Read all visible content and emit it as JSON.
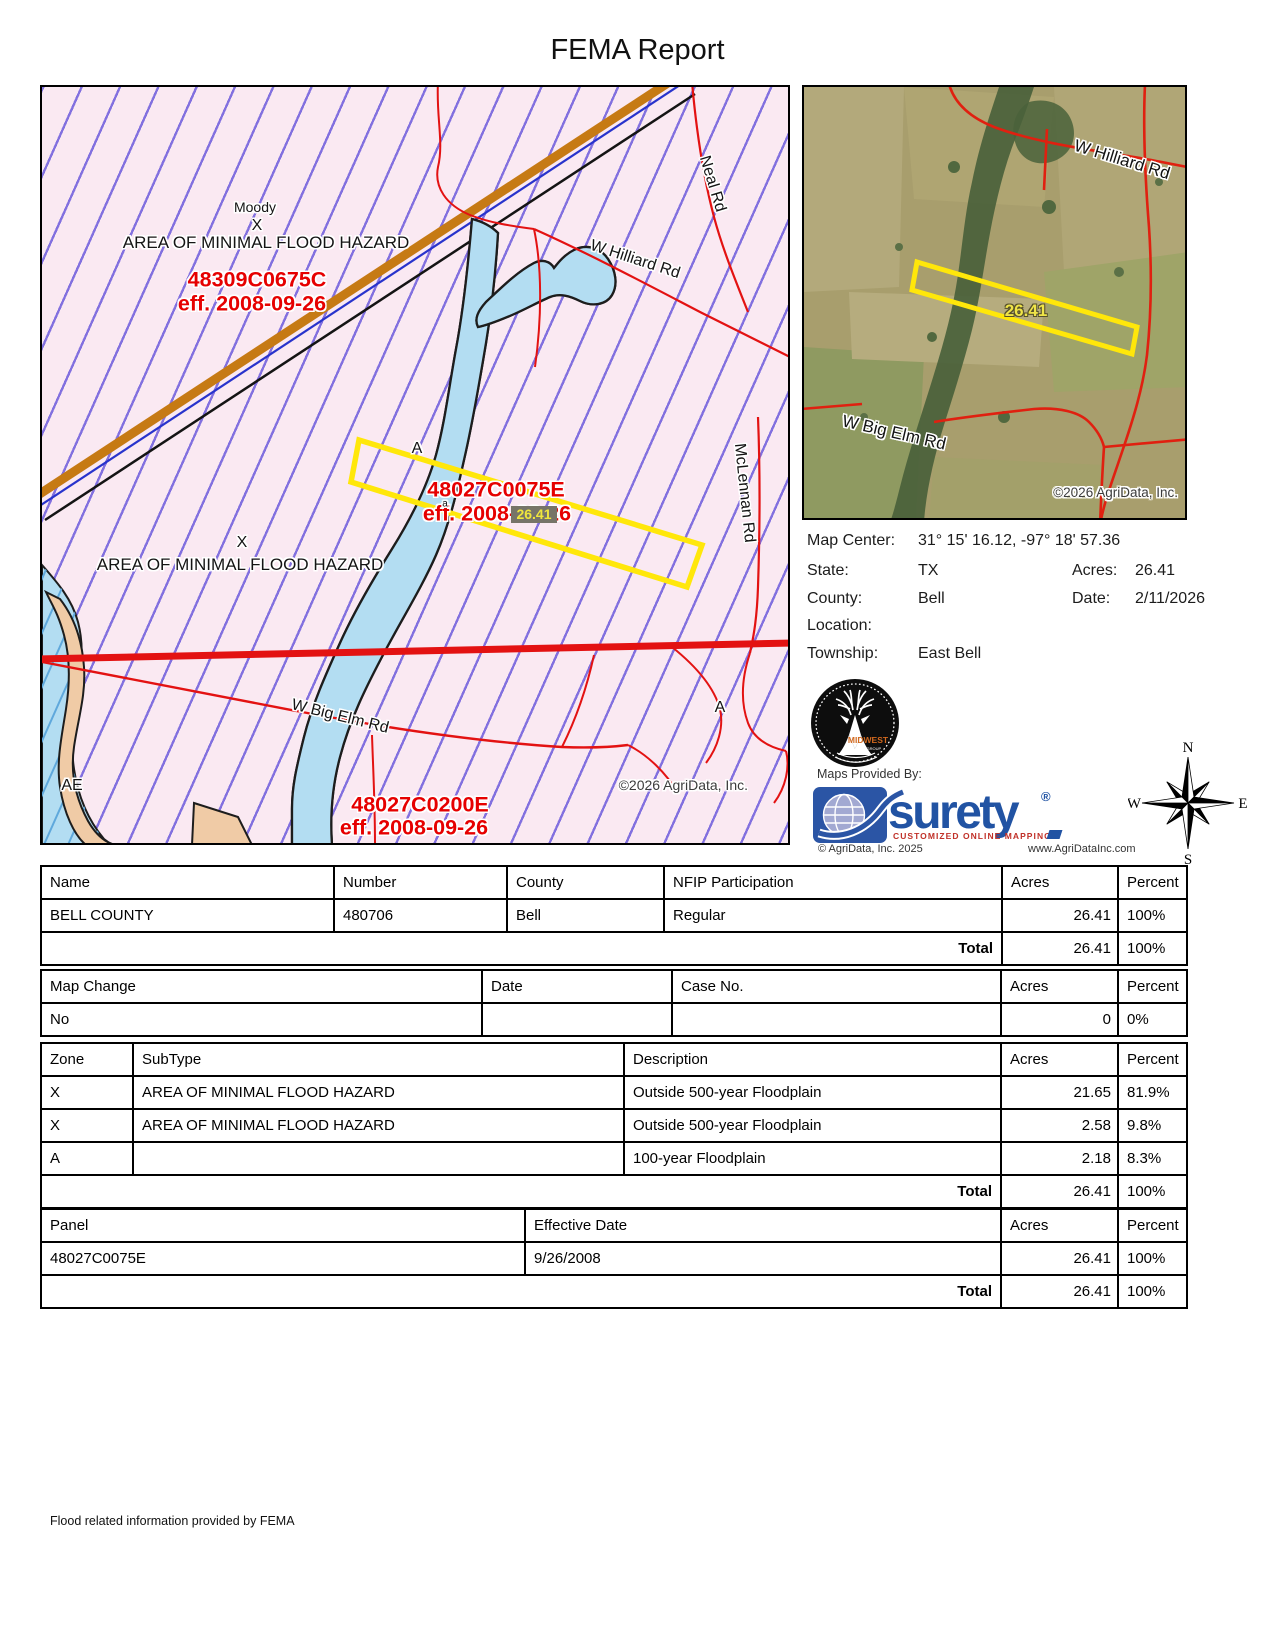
{
  "title": "FEMA Report",
  "flood_map": {
    "zone_labels": {
      "moody": "Moody",
      "x1": "X",
      "area1": "AREA OF MINIMAL FLOOD HAZARD",
      "x2": "X",
      "area2": "AREA OF MINIMAL FLOOD HAZARD",
      "a1": "A",
      "a2": "A",
      "ae": "AE"
    },
    "panels": {
      "p1": {
        "id": "48309C0675C",
        "eff": "eff. 2008-09-26"
      },
      "p2": {
        "id": "48027C0075E",
        "eff": "eff. 2008-09-26",
        "note": "a"
      },
      "p3": {
        "id": "48027C0200E",
        "eff": "eff. 2008-09-26"
      }
    },
    "acres_tag": "26.41",
    "roads": {
      "hilliard": "W Hilliard Rd",
      "neal": "Neal Rd",
      "mclennan": "McLennan Rd",
      "big_elm": "W Big Elm Rd"
    },
    "copyright": "©2026 AgriData, Inc."
  },
  "aerial_map": {
    "roads": {
      "hilliard": "W Hilliard Rd",
      "big_elm": "W Big Elm Rd"
    },
    "acres_label": "26.41",
    "copyright": "©2026 AgriData, Inc."
  },
  "info": {
    "map_center_label": "Map Center:",
    "map_center": "31° 15' 16.12,  -97° 18' 57.36",
    "state_label": "State:",
    "state": "TX",
    "acres_label": "Acres:",
    "acres": "26.41",
    "county_label": "County:",
    "county": "Bell",
    "date_label": "Date:",
    "date": "2/11/2026",
    "location_label": "Location:",
    "location": "",
    "township_label": "Township:",
    "township": "East Bell"
  },
  "branding": {
    "midwest_name": "MIDWEST",
    "midwest_sub": "LAND GROUP",
    "maps_provided_by": "Maps Provided By:",
    "surety": "surety",
    "registered": "®",
    "tagline": "CUSTOMIZED ONLINE MAPPING",
    "agridata_copyright": "© AgriData, Inc. 2025",
    "agridata_url": "www.AgriDataInc.com"
  },
  "compass": {
    "n": "N",
    "e": "E",
    "s": "S",
    "w": "W"
  },
  "tables": {
    "nfip": {
      "headers": [
        "Name",
        "Number",
        "County",
        "NFIP Participation",
        "Acres",
        "Percent"
      ],
      "rows": [
        [
          "BELL COUNTY",
          "480706",
          "Bell",
          "Regular",
          "26.41",
          "100%"
        ]
      ],
      "total": {
        "label": "Total",
        "acres": "26.41",
        "percent": "100%"
      }
    },
    "map_change": {
      "headers": [
        "Map Change",
        "Date",
        "Case No.",
        "Acres",
        "Percent"
      ],
      "rows": [
        [
          "No",
          "",
          "",
          "0",
          "0%"
        ]
      ]
    },
    "zones": {
      "headers": [
        "Zone",
        "SubType",
        "Description",
        "Acres",
        "Percent"
      ],
      "rows": [
        [
          "X",
          "AREA OF MINIMAL FLOOD HAZARD",
          "Outside 500-year Floodplain",
          "21.65",
          "81.9%"
        ],
        [
          "X",
          "AREA OF MINIMAL FLOOD HAZARD",
          "Outside 500-year Floodplain",
          "2.58",
          "9.8%"
        ],
        [
          "A",
          "",
          "100-year Floodplain",
          "2.18",
          "8.3%"
        ]
      ],
      "total": {
        "label": "Total",
        "acres": "26.41",
        "percent": "100%"
      }
    },
    "panels": {
      "headers": [
        "Panel",
        "Effective Date",
        "Acres",
        "Percent"
      ],
      "rows": [
        [
          "48027C0075E",
          "9/26/2008",
          "26.41",
          "100%"
        ]
      ],
      "total": {
        "label": "Total",
        "acres": "26.41",
        "percent": "100%"
      }
    }
  },
  "footer": "Flood related information provided by FEMA"
}
